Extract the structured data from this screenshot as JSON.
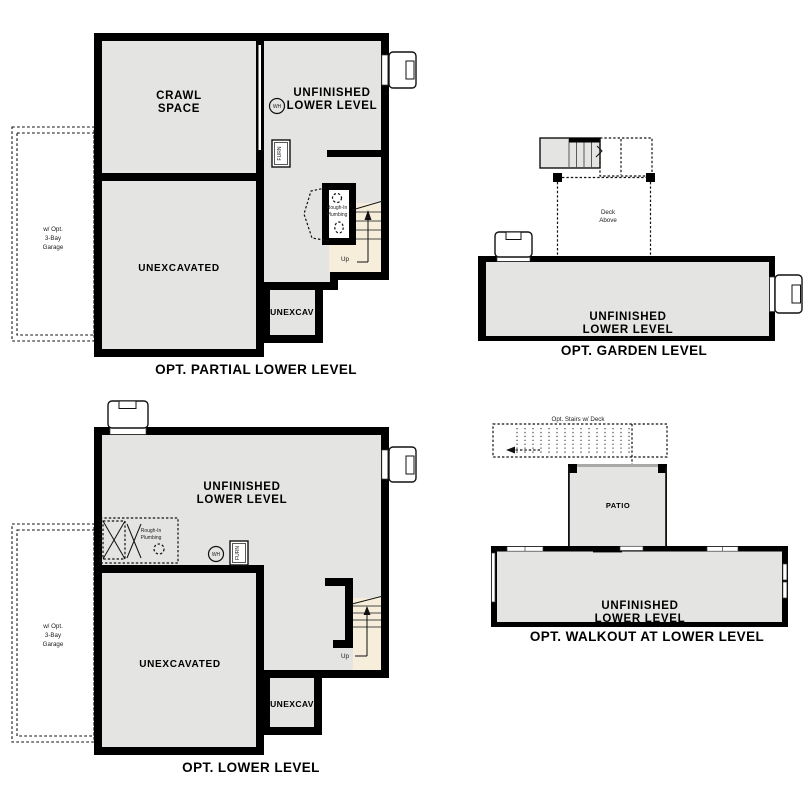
{
  "colors": {
    "wall": "#000000",
    "room_fill": "#e4e4e2",
    "stair_fill": "#f6edda",
    "background": "#ffffff"
  },
  "plan_partial": {
    "caption": "OPT. PARTIAL LOWER LEVEL",
    "crawl": [
      "CRAWL",
      "SPACE"
    ],
    "unfinished": [
      "UNFINISHED",
      "LOWER LEVEL"
    ],
    "unexcavated": "UNEXCAVATED",
    "unexcav": "UNEXCAV",
    "wh": "WH",
    "furn": "FURN",
    "rough_in": [
      "Rough-In",
      "Plumbing"
    ],
    "up": "Up",
    "garage": [
      "w/ Opt.",
      "3-Bay",
      "Garage"
    ]
  },
  "plan_garden": {
    "caption": "OPT. GARDEN LEVEL",
    "deck": [
      "Deck",
      "Above"
    ],
    "unfinished": [
      "UNFINISHED",
      "LOWER LEVEL"
    ]
  },
  "plan_lower": {
    "caption": "OPT. LOWER LEVEL",
    "unfinished": [
      "UNFINISHED",
      "LOWER LEVEL"
    ],
    "unexcavated": "UNEXCAVATED",
    "unexcav": "UNEXCAV",
    "wh": "WH",
    "furn": "FURN",
    "rough_in": [
      "Rough-In",
      "Plumbing"
    ],
    "up": "Up",
    "garage": [
      "w/ Opt.",
      "3-Bay",
      "Garage"
    ]
  },
  "plan_walkout": {
    "caption": "OPT. WALKOUT AT LOWER LEVEL",
    "opt_stairs": "Opt. Stairs w/ Deck",
    "patio": "PATIO",
    "unfinished": [
      "UNFINISHED",
      "LOWER LEVEL"
    ]
  }
}
